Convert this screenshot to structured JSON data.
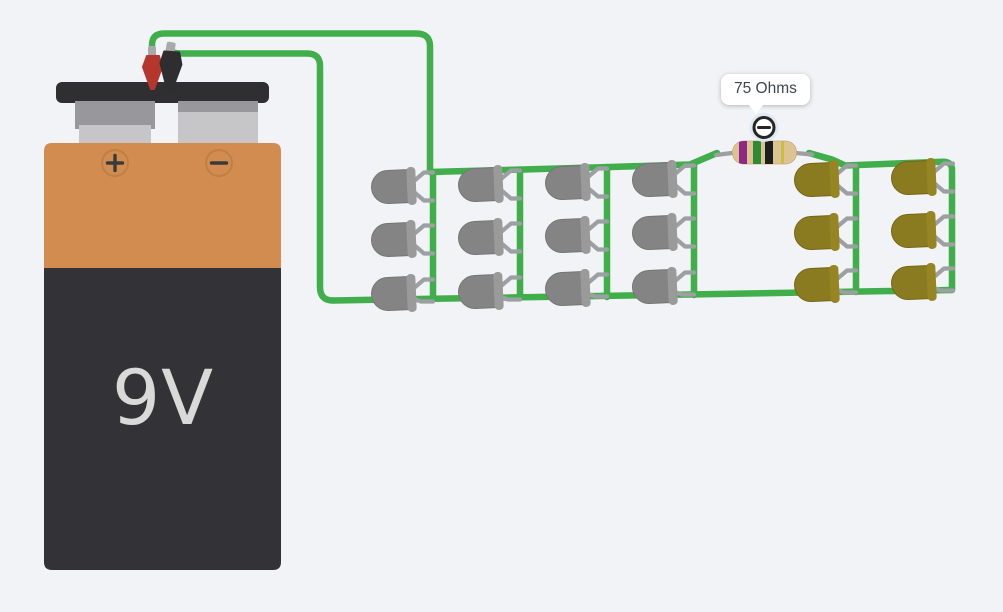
{
  "tooltip": {
    "text": "75 Ohms"
  },
  "wires": {
    "color": "#40ae4a"
  },
  "battery": {
    "label": "9V",
    "label_color": "#d9d9d9",
    "positive_symbol": "+",
    "negative_symbol": "−",
    "body_orange": "#d28c50",
    "body_dark": "#333236",
    "cap_color": "#2f2f31",
    "terminal_dark": "#98979b",
    "terminal_light": "#c6c5c7",
    "symbol_ring": "#bd8045",
    "symbol_color": "#3a3a3c"
  },
  "clips": {
    "positive_color": "#b5362d",
    "negative_color": "#2e2e30",
    "ferrule_color": "#a9a9a9"
  },
  "resistor": {
    "value": "75 Ohms",
    "body_color": "#ddc394",
    "bands": [
      "#8e2786",
      "#2f8b33",
      "#1e1e1e",
      "#c9bd44"
    ]
  },
  "leds": {
    "lead_color": "#9da0a2",
    "groups": [
      {
        "name": "gray",
        "rows": 3,
        "columns": 4,
        "color": "#848484",
        "stroke": "#767676",
        "flange": "#9a9a9a"
      },
      {
        "name": "yellow",
        "rows": 3,
        "columns": 2,
        "color": "#8a7a20",
        "stroke": "#746716",
        "flange": "#968522"
      }
    ]
  },
  "badge": {
    "symbol": "−"
  }
}
